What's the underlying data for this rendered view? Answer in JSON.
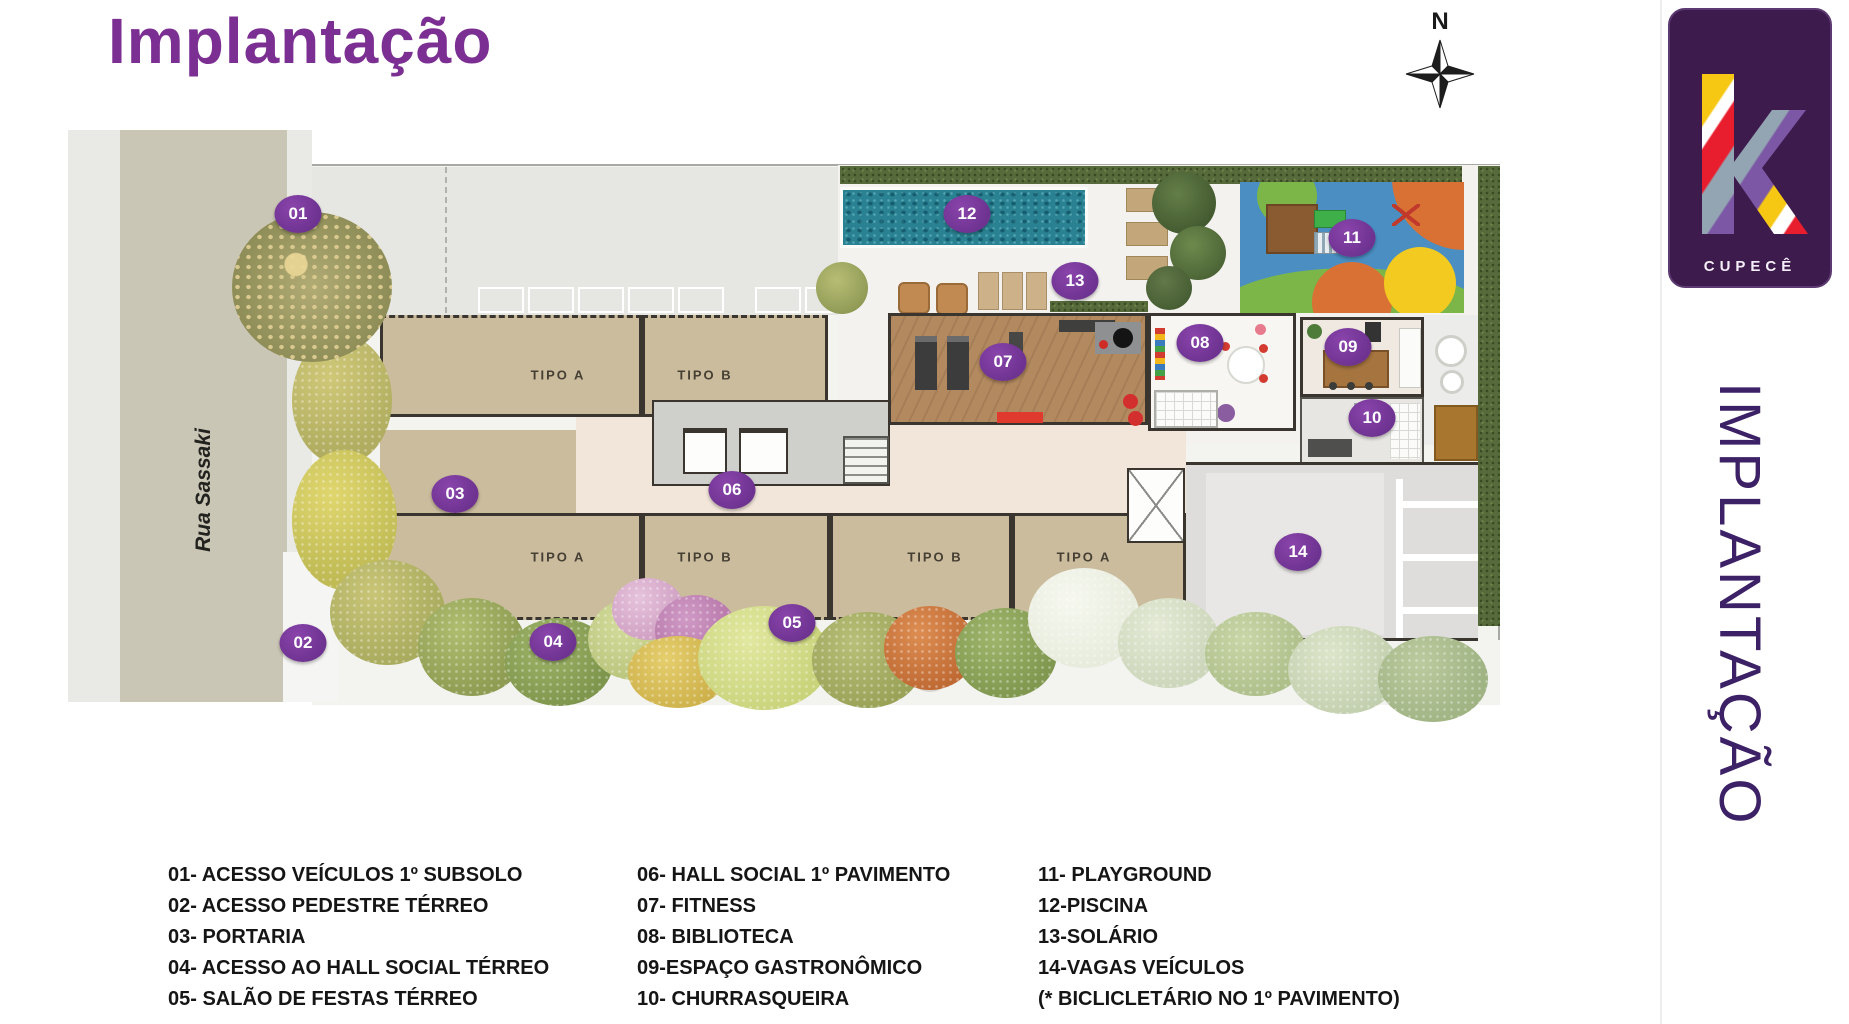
{
  "title": "Implantação",
  "compass": {
    "label": "N"
  },
  "brand": {
    "letter_mark": "k",
    "name": "CUPECÊ"
  },
  "side_label": "IMPLANTAÇÃO",
  "plan": {
    "street_name": "Rua Sassaki",
    "unit_labels": [
      "TIPO A",
      "TIPO B",
      "TIPO A",
      "TIPO B",
      "TIPO B",
      "TIPO A"
    ],
    "markers": [
      "01",
      "02",
      "03",
      "04",
      "05",
      "06",
      "07",
      "08",
      "09",
      "10",
      "11",
      "12",
      "13",
      "14"
    ]
  },
  "legend": {
    "columns": [
      [
        "01-  ACESSO VEÍCULOS 1º SUBSOLO",
        "02- ACESSO PEDESTRE TÉRREO",
        "03- PORTARIA",
        "04- ACESSO AO HALL SOCIAL TÉRREO",
        "05- SALÃO DE FESTAS TÉRREO"
      ],
      [
        "06- HALL SOCIAL 1º PAVIMENTO",
        "07- FITNESS",
        "08- BIBLIOTECA",
        "09-ESPAÇO GASTRONÔMICO",
        "10- CHURRASQUEIRA"
      ],
      [
        "11- PLAYGROUND",
        "12-PISCINA",
        "13-SOLÁRIO",
        "14-VAGAS VEÍCULOS",
        "(* BICLICLETÁRIO NO 1º PAVIMENTO)"
      ]
    ]
  },
  "colors": {
    "accent_purple": "#7c2f92",
    "marker_purple": "#6e3391",
    "side_label_purple": "#3c2166",
    "logo_background": "#3d1b4d"
  }
}
